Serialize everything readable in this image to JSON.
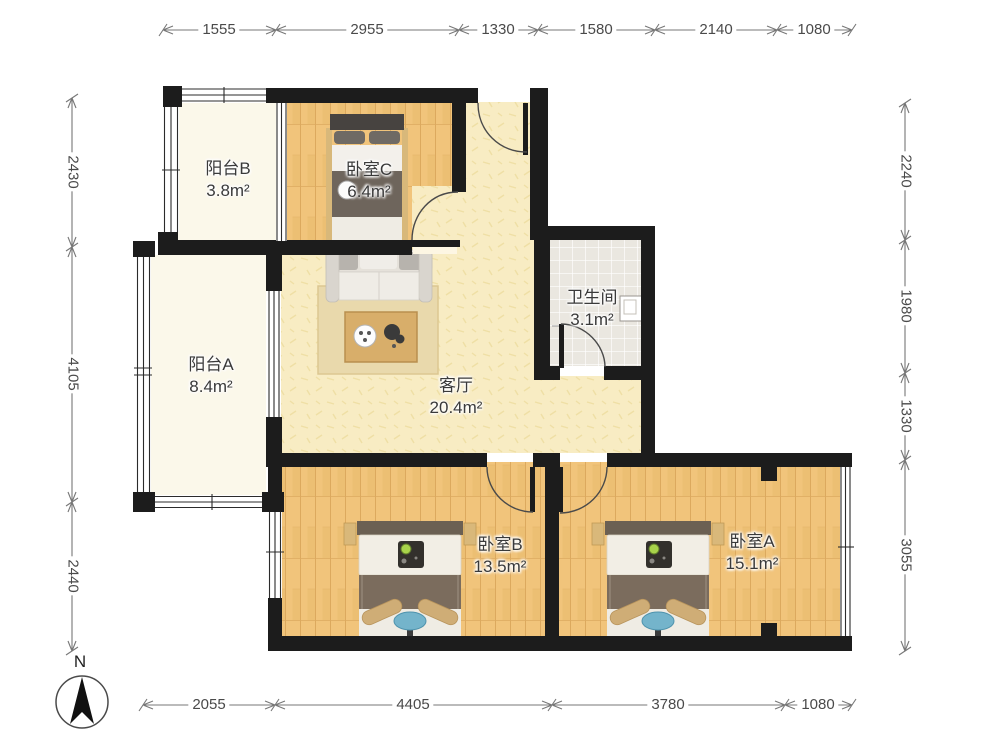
{
  "rooms": {
    "balcony_b": {
      "name": "阳台B",
      "area": "3.8m²"
    },
    "bedroom_c": {
      "name": "卧室C",
      "area": "6.4m²"
    },
    "balcony_a": {
      "name": "阳台A",
      "area": "8.4m²"
    },
    "living_room": {
      "name": "客厅",
      "area": "20.4m²"
    },
    "bathroom": {
      "name": "卫生间",
      "area": "3.1m²"
    },
    "bedroom_b": {
      "name": "卧室B",
      "area": "13.5m²"
    },
    "bedroom_a": {
      "name": "卧室A",
      "area": "15.1m²"
    }
  },
  "dimensions_mm": {
    "top": [
      "1555",
      "2955",
      "1330",
      "1580",
      "2140",
      "1080"
    ],
    "left": [
      "2430",
      "4105",
      "2440"
    ],
    "right": [
      "2240",
      "1980",
      "1330",
      "3055"
    ],
    "bottom": [
      "2055",
      "4405",
      "3780",
      "1080"
    ]
  },
  "compass": {
    "label": "N"
  },
  "colors": {
    "wall": "#1c1c1c",
    "wood_floor": "#f1c47b",
    "living_floor": "#f8ecc3",
    "balcony_floor": "#fbf8ea",
    "tile_floor": "#eae7e0",
    "dimension_text": "#4a4a4a"
  }
}
